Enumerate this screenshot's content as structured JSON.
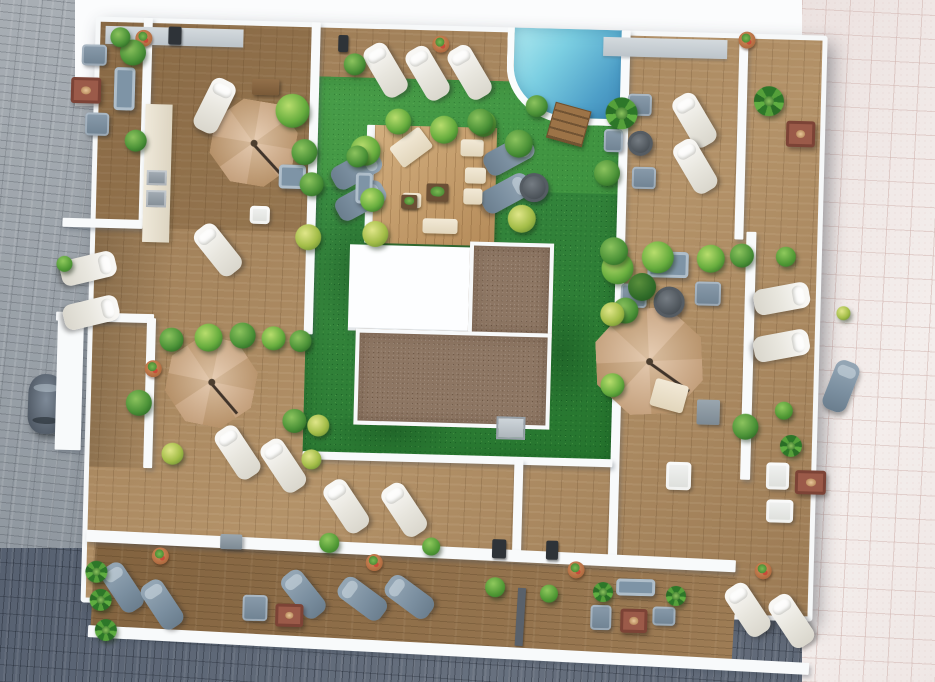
{
  "scene_type": "rooftop-terrace-3d-aerial-render",
  "palette": {
    "deck_wood": "#a8865d",
    "balcony_wood": "#93714a",
    "lawn_green": "#2e8736",
    "pool_light": "#a9e6ee",
    "pool_deep": "#3c85b4",
    "umbrella_tan": "#d2ad85",
    "parapet_white": "#f8fafb",
    "gravel_brown": "#8d7663",
    "building_white": "#fdfeff",
    "sidewalk_gray": "#9ba3ab",
    "street_dark": "#5f6876",
    "sidewalk_pink": "#f0e8e6",
    "cushion_white": "#f2f1ee",
    "cushion_slate": "#7b8fa0",
    "fire_table_red": "#9b5a49"
  },
  "pavements": [
    {
      "cls": "pav-gray",
      "name": "sidewalk-left",
      "x": 0,
      "y": 0,
      "w": 132,
      "h": 575
    },
    {
      "cls": "pav-white",
      "name": "adjacent-roof-band-top",
      "x": 75,
      "y": 0,
      "w": 757,
      "h": 106
    },
    {
      "cls": "pav-dark",
      "name": "street-bottom",
      "x": 0,
      "y": 548,
      "w": 935,
      "h": 134
    },
    {
      "cls": "pav-pink",
      "name": "sidewalk-right",
      "x": 802,
      "y": 0,
      "w": 133,
      "h": 682
    }
  ],
  "car": {
    "x": 28,
    "y": 374,
    "w": 36,
    "h": 60,
    "rot": 2
  },
  "roof": {
    "x": 78,
    "y": 18,
    "w": 748,
    "h": 612,
    "rotate": 1.5,
    "surfaces": [
      {
        "cls": "deck",
        "name": "deck-base",
        "x": 88,
        "y": 26,
        "w": 732,
        "h": 586,
        "rot": 0
      },
      {
        "cls": "deck-dark",
        "name": "deck-shade-topleft",
        "x": 93,
        "y": 31,
        "w": 215,
        "h": 205,
        "rot": 0
      },
      {
        "cls": "deck-shadow",
        "name": "building-shadow-left",
        "x": 93,
        "y": 236,
        "w": 80,
        "h": 240,
        "rot": 0
      },
      {
        "cls": "lawn",
        "name": "lawn",
        "x": 306,
        "y": 80,
        "w": 310,
        "h": 382,
        "rot": 0
      },
      {
        "cls": "lawn-bright",
        "name": "lawn-sunlit",
        "x": 306,
        "y": 80,
        "w": 310,
        "h": 110,
        "rot": 0
      },
      {
        "cls": "lawn-patch",
        "name": "lawn-patch",
        "x": 312,
        "y": 200,
        "w": 85,
        "h": 140,
        "rot": 0
      },
      {
        "cls": "lawn-patch",
        "name": "lawn-patch",
        "x": 520,
        "y": 290,
        "w": 85,
        "h": 120,
        "rot": 0
      },
      {
        "cls": "lawn-patch",
        "name": "lawn-patch",
        "x": 330,
        "y": 408,
        "w": 130,
        "h": 50,
        "rot": 0
      },
      {
        "cls": "pool",
        "name": "swimming-pool",
        "x": 500,
        "y": 26,
        "w": 118,
        "h": 96,
        "rot": 0
      },
      {
        "cls": "steps",
        "name": "pool-steps",
        "x": 545,
        "y": 103,
        "w": 37,
        "h": 37,
        "rot": 14
      },
      {
        "cls": "wall",
        "name": "platform-edge",
        "x": 362,
        "y": 127,
        "w": 10,
        "h": 118,
        "rot": 0
      },
      {
        "cls": "platform",
        "name": "chillout-platform",
        "x": 370,
        "y": 127,
        "w": 122,
        "h": 118,
        "rot": 0
      },
      {
        "cls": "building",
        "name": "building-roof",
        "x": 348,
        "y": 247,
        "w": 132,
        "h": 86,
        "rot": 0
      },
      {
        "cls": "gravel",
        "name": "gravel-roof-upper",
        "x": 468,
        "y": 241,
        "w": 84,
        "h": 94,
        "rot": 0
      },
      {
        "cls": "gravel",
        "name": "gravel-roof-lower",
        "x": 356,
        "y": 331,
        "w": 196,
        "h": 96,
        "rot": 0
      },
      {
        "cls": "graybox",
        "name": "rooflight-box",
        "x": 499,
        "y": 415,
        "w": 29,
        "h": 23,
        "rot": 0
      },
      {
        "cls": "balcony",
        "name": "balcony-strip",
        "x": 100,
        "y": 558,
        "w": 642,
        "h": 88,
        "rot": 2
      },
      {
        "cls": "darkstrip",
        "name": "balcony-divider",
        "x": 524,
        "y": 586,
        "w": 8,
        "h": 58,
        "rot": 2
      },
      {
        "cls": "wall",
        "name": "privacy-wall",
        "x": 136,
        "y": 26,
        "w": 9,
        "h": 208,
        "rot": 0
      },
      {
        "cls": "wall",
        "name": "privacy-wall",
        "x": 304,
        "y": 26,
        "w": 9,
        "h": 312,
        "rot": 0
      },
      {
        "cls": "wall",
        "name": "privacy-wall",
        "x": 614,
        "y": 26,
        "w": 9,
        "h": 528,
        "rot": 0
      },
      {
        "cls": "wall",
        "name": "privacy-wall",
        "x": 732,
        "y": 26,
        "w": 9,
        "h": 206,
        "rot": 0
      },
      {
        "cls": "wall",
        "name": "privacy-wall",
        "x": 744,
        "y": 224,
        "w": 10,
        "h": 248,
        "rot": 0
      },
      {
        "cls": "wall",
        "name": "parapet-ledge",
        "x": 60,
        "y": 228,
        "w": 80,
        "h": 9,
        "rot": 0
      },
      {
        "cls": "wall",
        "name": "parapet-ledge",
        "x": 56,
        "y": 322,
        "w": 98,
        "h": 9,
        "rot": 0
      },
      {
        "cls": "wall",
        "name": "parapet-ledge",
        "x": 58,
        "y": 330,
        "w": 26,
        "h": 130,
        "rot": 0
      },
      {
        "cls": "wall",
        "name": "privacy-wall",
        "x": 147,
        "y": 326,
        "w": 9,
        "h": 150,
        "rot": 0
      },
      {
        "cls": "wall",
        "name": "lawn-front-parapet",
        "x": 306,
        "y": 455,
        "w": 310,
        "h": 8,
        "rot": 0
      },
      {
        "cls": "wall",
        "name": "privacy-wall",
        "x": 518,
        "y": 458,
        "w": 9,
        "h": 98,
        "rot": 0
      },
      {
        "cls": "wall",
        "name": "roof-front-parapet",
        "x": 92,
        "y": 546,
        "w": 650,
        "h": 12,
        "rot": 1.2
      },
      {
        "cls": "wall",
        "name": "street-front-parapet",
        "x": 96,
        "y": 644,
        "w": 722,
        "h": 12,
        "rot": 1.5
      },
      {
        "cls": "counter",
        "name": "outdoor-kitchen-counter",
        "x": 140,
        "y": 112,
        "w": 27,
        "h": 138,
        "rot": 0
      },
      {
        "cls": "vent",
        "name": "roof-vent",
        "x": 98,
        "y": 35,
        "w": 138,
        "h": 18,
        "rot": 0
      },
      {
        "cls": "vent",
        "name": "roof-vent",
        "x": 596,
        "y": 33,
        "w": 124,
        "h": 19,
        "rot": 0
      }
    ],
    "umbrellas": [
      [
        207,
        106,
        84,
        8
      ],
      [
        597,
        303,
        106,
        -4
      ],
      [
        169,
        344,
        88,
        10
      ]
    ],
    "loungers_white": [
      [
        366,
        44,
        -32
      ],
      [
        408,
        46,
        -32
      ],
      [
        450,
        44,
        -32
      ],
      [
        196,
        84,
        25
      ],
      [
        676,
        86,
        -32
      ],
      [
        678,
        132,
        -32
      ],
      [
        74,
        250,
        75
      ],
      [
        78,
        294,
        75
      ],
      [
        203,
        228,
        -40
      ],
      [
        768,
        262,
        78
      ],
      [
        769,
        309,
        78
      ],
      [
        338,
        481,
        -35
      ],
      [
        396,
        483,
        -35
      ],
      [
        742,
        574,
        -35
      ],
      [
        786,
        584,
        -35
      ],
      [
        228,
        430,
        -35
      ],
      [
        274,
        442,
        -35
      ]
    ],
    "loungers_gray": [
      [
        340,
        146,
        60
      ],
      [
        345,
        177,
        60
      ],
      [
        492,
        128,
        60
      ],
      [
        490,
        166,
        60
      ],
      [
        117,
        570,
        -35
      ],
      [
        157,
        586,
        -35
      ],
      [
        357,
        575,
        -55
      ],
      [
        404,
        572,
        -55
      ],
      [
        298,
        572,
        -40
      ],
      [
        830,
        350,
        20
      ]
    ],
    "sofas": [
      [
        108,
        76,
        21,
        43
      ],
      [
        275,
        169,
        27,
        24
      ],
      [
        646,
        246,
        41,
        26
      ],
      [
        623,
        574,
        39,
        17
      ],
      [
        352,
        175,
        17,
        31
      ]
    ],
    "chairs_white": [
      [
        247,
        211,
        20,
        18
      ],
      [
        770,
        454,
        23,
        27
      ],
      [
        771,
        491,
        27,
        23
      ],
      [
        670,
        456,
        25,
        28
      ]
    ],
    "chairs_gray": [
      [
        75,
        54,
        25,
        21
      ],
      [
        80,
        122,
        24,
        23
      ],
      [
        620,
        279,
        26,
        24
      ],
      [
        694,
        275,
        26,
        24
      ],
      [
        622,
        89,
        24,
        22
      ],
      [
        599,
        125,
        19,
        23
      ],
      [
        628,
        162,
        24,
        22
      ],
      [
        250,
        600,
        25,
        26
      ],
      [
        598,
        601,
        21,
        25
      ],
      [
        660,
        601,
        23,
        19
      ]
    ],
    "benches": [
      [
        246,
        84,
        27,
        16
      ]
    ],
    "fire_tables": [
      [
        65,
        87,
        30,
        26
      ],
      [
        781,
        112,
        29,
        26
      ],
      [
        799,
        461,
        31,
        24
      ],
      [
        628,
        604,
        27,
        24
      ],
      [
        283,
        608,
        28,
        23
      ]
    ],
    "round_tables": [
      [
        623,
        126,
        25
      ],
      [
        516,
        171,
        29
      ],
      [
        653,
        281,
        31
      ]
    ],
    "gray_squares": [
      [
        699,
        393,
        23,
        25
      ],
      [
        226,
        540,
        22,
        15
      ]
    ],
    "mats": [
      [
        388,
        136,
        37,
        25,
        -38
      ],
      [
        456,
        139,
        23,
        17,
        0
      ],
      [
        461,
        167,
        21,
        16,
        0
      ],
      [
        399,
        194,
        19,
        15,
        0
      ],
      [
        460,
        188,
        19,
        16,
        0
      ],
      [
        420,
        219,
        35,
        15,
        0
      ],
      [
        654,
        376,
        34,
        28,
        14
      ]
    ],
    "dark_squares": [
      [
        423,
        184,
        22,
        18
      ],
      [
        398,
        196,
        16,
        14
      ]
    ],
    "appliances": [
      [
        143,
        178,
        20,
        15
      ],
      [
        143,
        198,
        20,
        17
      ]
    ],
    "fixtures": [
      [
        161,
        34,
        13,
        18
      ],
      [
        331,
        38,
        10,
        17
      ],
      [
        498,
        538,
        14,
        19
      ],
      [
        552,
        538,
        12,
        19
      ]
    ],
    "pots": [
      [
        128,
        38
      ],
      [
        425,
        36
      ],
      [
        731,
        24
      ],
      [
        761,
        554
      ],
      [
        146,
        368
      ],
      [
        372,
        556
      ],
      [
        574,
        558
      ],
      [
        158,
        555
      ]
    ],
    "plants": [
      [
        113,
        48,
        13,
        "mid"
      ],
      [
        120,
        138,
        11,
        "mid"
      ],
      [
        103,
        36,
        10,
        "mid"
      ],
      [
        346,
        138,
        15,
        "bright"
      ],
      [
        337,
        56,
        11,
        "mid"
      ],
      [
        270,
        98,
        17,
        "bright"
      ],
      [
        287,
        143,
        13,
        "mid"
      ],
      [
        293,
        228,
        13,
        "yellow"
      ],
      [
        296,
        176,
        12,
        "mid"
      ],
      [
        380,
        110,
        13,
        "bright"
      ],
      [
        425,
        116,
        14,
        "bright"
      ],
      [
        465,
        110,
        13,
        "bright"
      ],
      [
        500,
        128,
        14,
        "mid"
      ],
      [
        342,
        148,
        11,
        "mid"
      ],
      [
        357,
        190,
        12,
        "bright"
      ],
      [
        360,
        223,
        13,
        "yellow"
      ],
      [
        505,
        203,
        14,
        "yellow"
      ],
      [
        462,
        108,
        13,
        "mid"
      ],
      [
        520,
        93,
        11,
        "mid"
      ],
      [
        600,
        93,
        16,
        "palm"
      ],
      [
        590,
        156,
        13,
        "mid"
      ],
      [
        748,
        78,
        15,
        "palm"
      ],
      [
        600,
        248,
        16,
        "bright"
      ],
      [
        612,
        293,
        13,
        "mid"
      ],
      [
        627,
        268,
        14,
        "dark"
      ],
      [
        598,
        233,
        14,
        "mid"
      ],
      [
        640,
        236,
        16,
        "bright"
      ],
      [
        695,
        238,
        14,
        "bright"
      ],
      [
        728,
        236,
        12,
        "mid"
      ],
      [
        600,
        298,
        12,
        "yellow"
      ],
      [
        602,
        369,
        12,
        "bright"
      ],
      [
        735,
        406,
        13,
        "mid"
      ],
      [
        783,
        426,
        11,
        "palm"
      ],
      [
        160,
        335,
        12,
        "mid"
      ],
      [
        195,
        330,
        14,
        "bright"
      ],
      [
        230,
        328,
        13,
        "mid"
      ],
      [
        262,
        331,
        12,
        "bright"
      ],
      [
        290,
        334,
        11,
        "mid"
      ],
      [
        128,
        398,
        13,
        "mid"
      ],
      [
        165,
        450,
        11,
        "yellow"
      ],
      [
        285,
        413,
        12,
        "mid"
      ],
      [
        310,
        418,
        11,
        "yellow"
      ],
      [
        305,
        453,
        10,
        "yellow"
      ],
      [
        92,
        570,
        11,
        "palm"
      ],
      [
        97,
        598,
        11,
        "palm"
      ],
      [
        103,
        628,
        11,
        "palm"
      ],
      [
        600,
        578,
        10,
        "palm"
      ],
      [
        673,
        580,
        10,
        "palm"
      ],
      [
        836,
        296,
        7,
        "yellow"
      ]
    ],
    "balls": [
      [
        774,
        238,
        10
      ],
      [
        777,
        393,
        9
      ],
      [
        325,
        536,
        10
      ],
      [
        428,
        538,
        9
      ],
      [
        492,
        576,
        10
      ],
      [
        547,
        582,
        9
      ],
      [
        55,
        266,
        8
      ]
    ]
  }
}
